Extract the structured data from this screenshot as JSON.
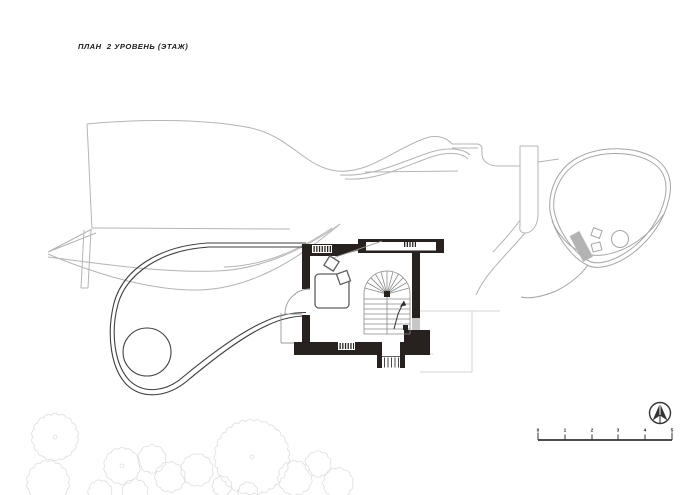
{
  "title": "ПЛАН  2 УРОВЕНЬ (ЭТАЖ)",
  "scale_bar": {
    "labels": [
      "0",
      "1",
      "2",
      "3",
      "4",
      "5"
    ]
  },
  "icons": {
    "north_arrow": "north-arrow-compass"
  },
  "colors": {
    "background": "#ffffff",
    "wall": "#272220",
    "dark_line": "#3f3f3f",
    "roof_line": "#b4b4b4",
    "terrace_line": "#a5a5a5",
    "faint_line": "#c9c9c9",
    "tree_line": "#dedede",
    "gray_fill": "#c6c6c6",
    "fixture_fill": "#b3b3b3",
    "text": "#1a1a1a"
  }
}
